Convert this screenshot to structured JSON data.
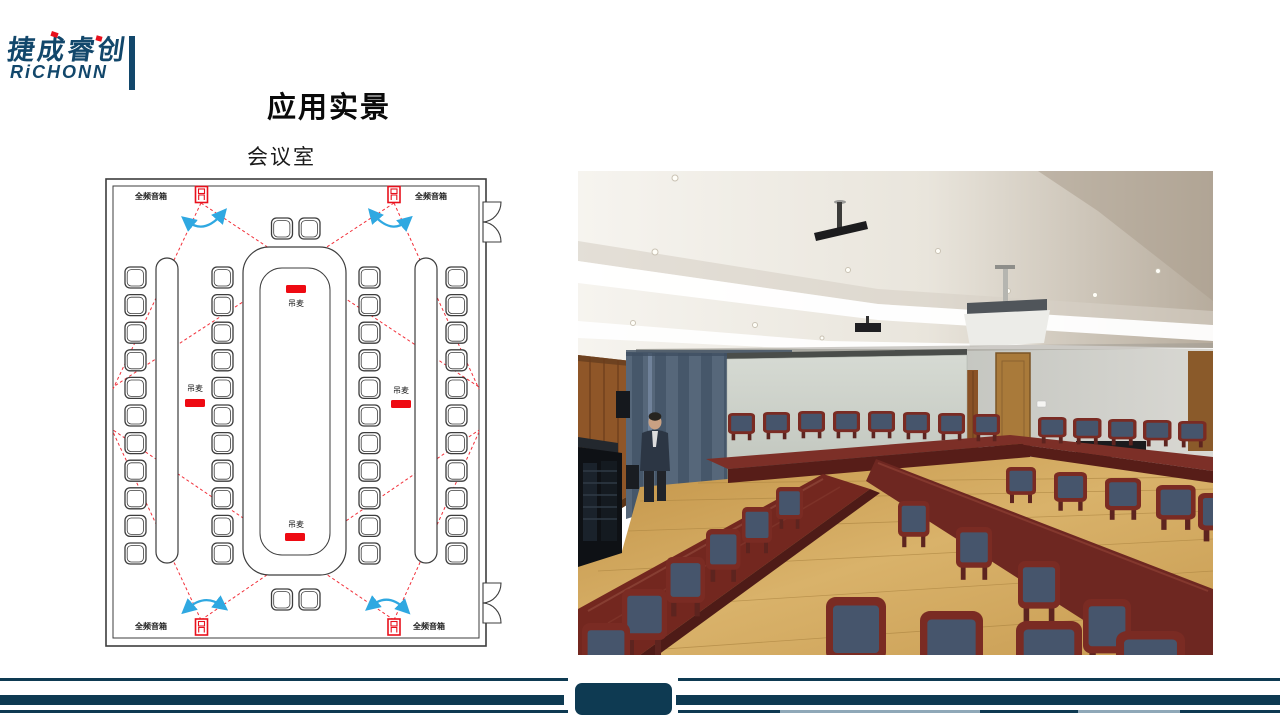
{
  "logo": {
    "name_cn": "捷成睿创",
    "name_en": "RiCHONN"
  },
  "slide": {
    "title": "应用实景",
    "subtitle": "会议室"
  },
  "diagram": {
    "type": "conference-room-layout",
    "speaker_label": "全频音箱",
    "mic_label": "吊麦",
    "speakers": [
      {
        "position": "top-left"
      },
      {
        "position": "top-right"
      },
      {
        "position": "bottom-left"
      },
      {
        "position": "bottom-right"
      }
    ],
    "mics": [
      {
        "position": "table-top"
      },
      {
        "position": "left-row"
      },
      {
        "position": "right-row"
      },
      {
        "position": "table-bottom"
      }
    ],
    "chair_columns": 4,
    "chairs_per_column": 11,
    "head_chairs_top": 2,
    "head_chairs_bottom": 2,
    "doors_on_right_wall": 2
  },
  "photo": {
    "label": "conference-room-photo"
  },
  "colors": {
    "brand_navy": "#12476b",
    "footer_navy": "#0e3a52",
    "footer_light_blue": "#8fa8b8",
    "diagram_red": "#ee1c25",
    "arrow_blue": "#2fa8e1"
  }
}
